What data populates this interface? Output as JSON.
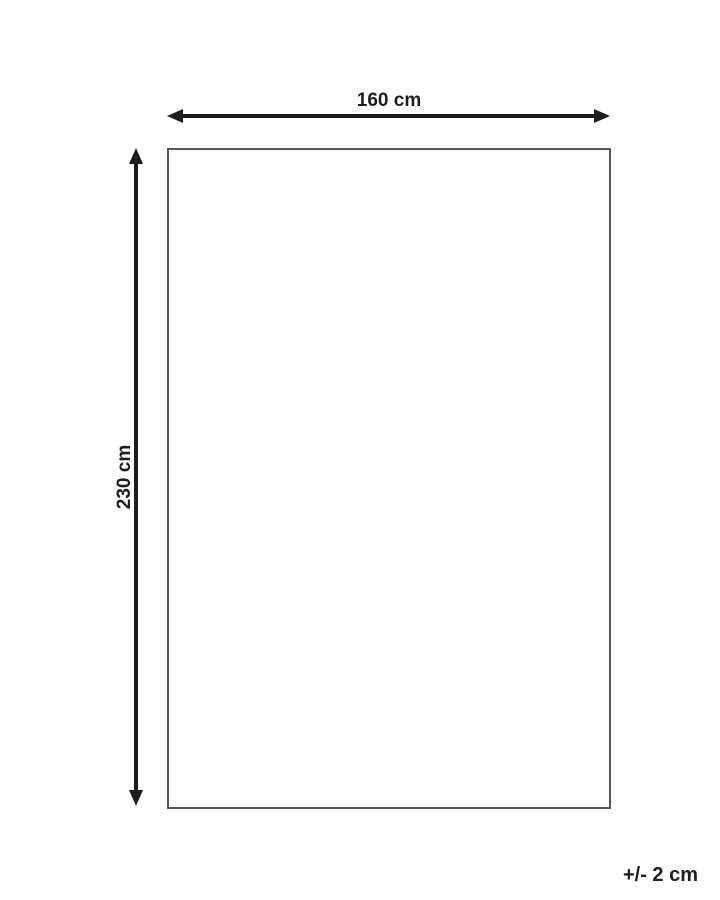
{
  "diagram": {
    "type": "product-dimension-diagram",
    "width_label": "160 cm",
    "height_label": "230 cm",
    "tolerance_label": "+/- 2 cm"
  },
  "colors": {
    "line": "#1d1d1b",
    "text": "#1d1d1b",
    "outline": "#58585a",
    "background": "#ffffff"
  }
}
